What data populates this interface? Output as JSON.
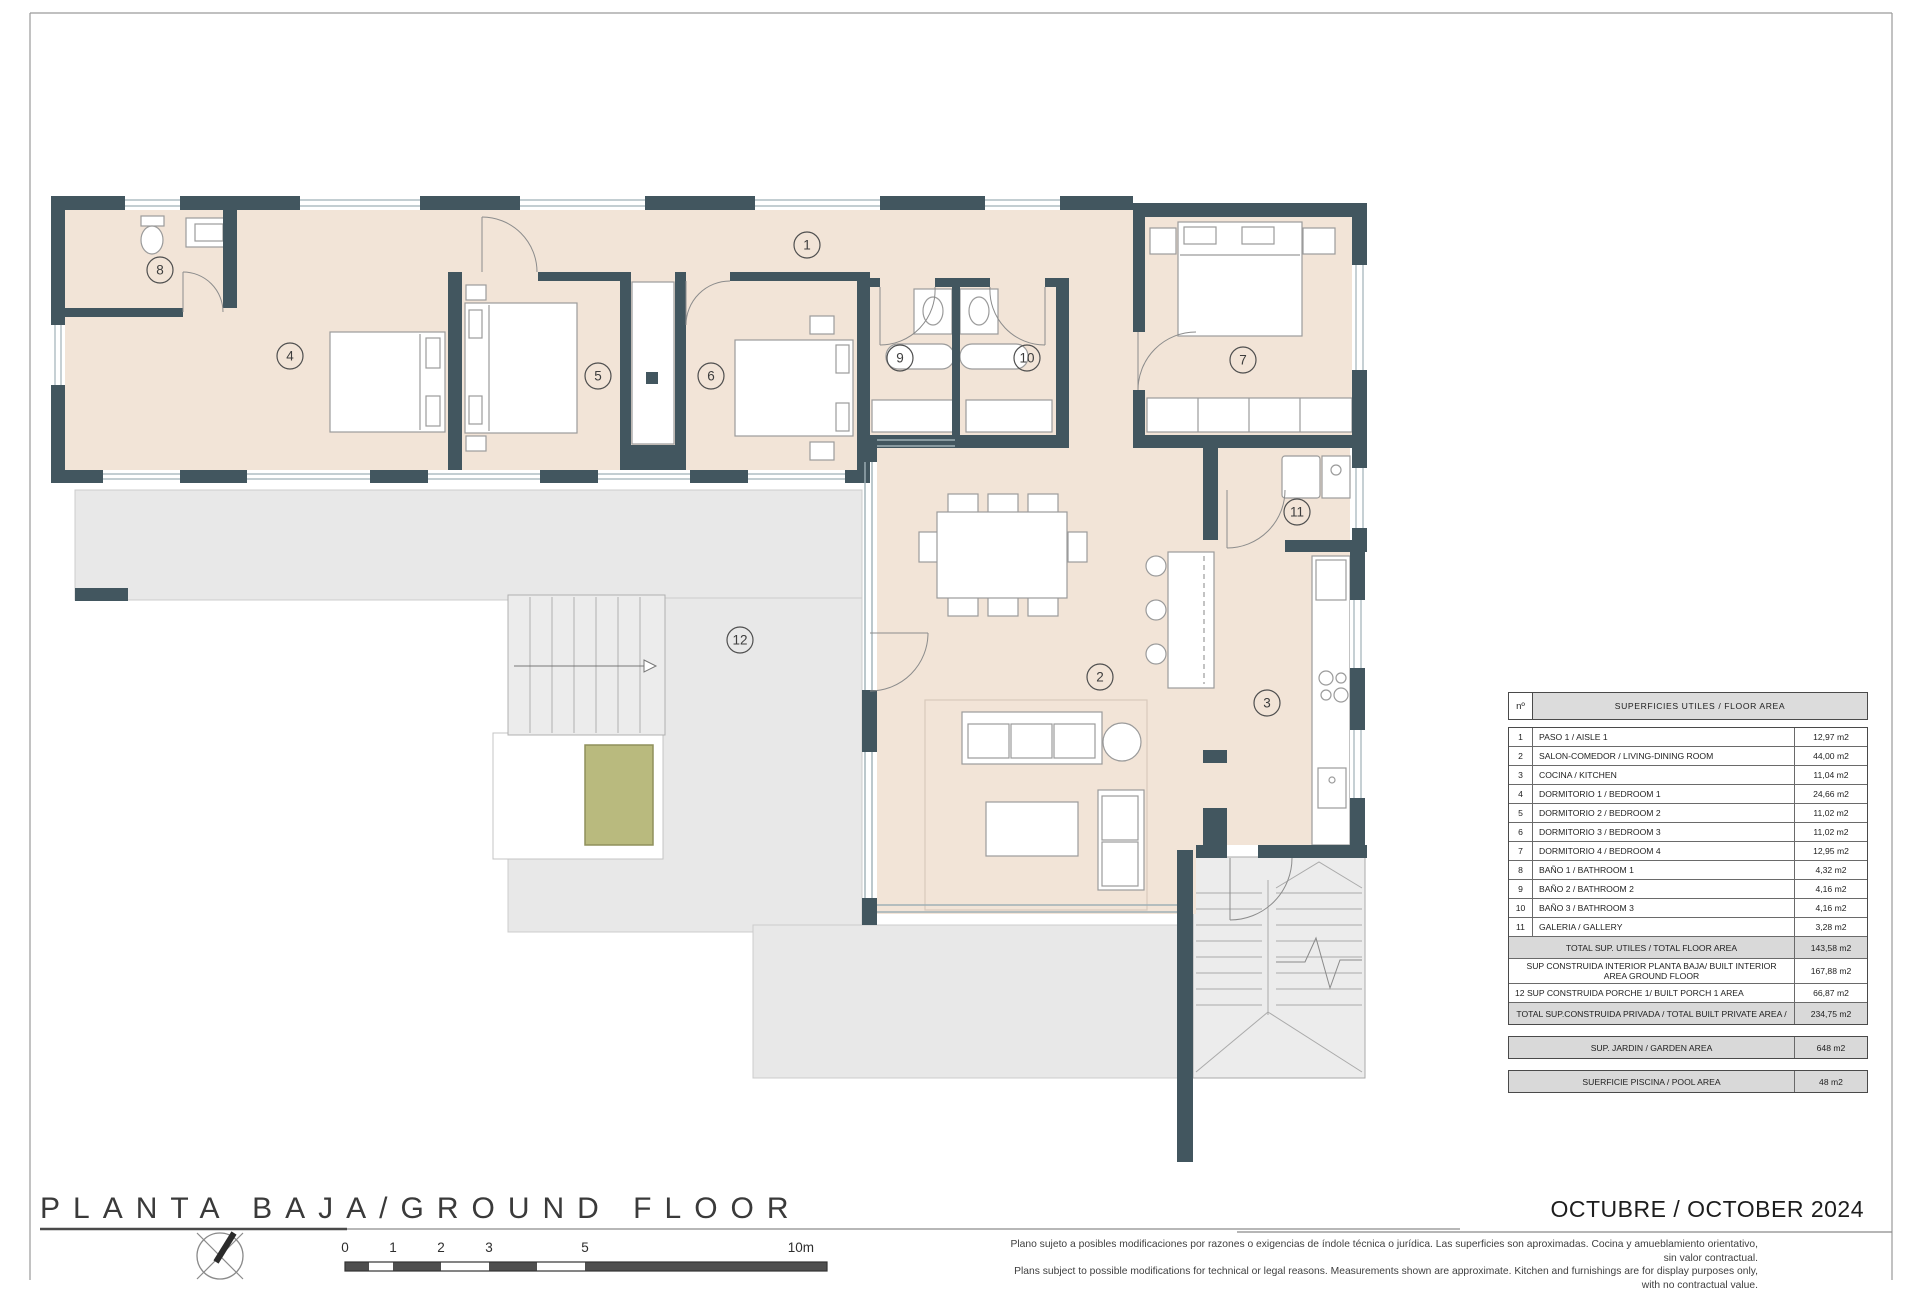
{
  "sheet": {
    "title": "PLANTA BAJA/GROUND FLOOR",
    "date": "OCTUBRE / OCTOBER 2024",
    "disclaimer_line1": "Plano sujeto a posibles modificaciones por razones o exigencias de índole técnica o jurídica. Las superficies son aproximadas. Cocina y amueblamiento orientativo, sin valor contractual.",
    "disclaimer_line2": "Plans subject to possible modifications for technical or legal reasons. Measurements shown are approximate. Kitchen and furnishings are for display purposes only, with no contractual value."
  },
  "table": {
    "header_num": "nº",
    "header_title": "SUPERFICIES UTILES  / FLOOR AREA",
    "rows": [
      {
        "num": "1",
        "label": "PASO 1 / AISLE 1",
        "value": "12,97 m2"
      },
      {
        "num": "2",
        "label": "SALON-COMEDOR /  LIVING-DINING ROOM",
        "value": "44,00 m2"
      },
      {
        "num": "3",
        "label": "COCINA / KITCHEN",
        "value": "11,04 m2"
      },
      {
        "num": "4",
        "label": "DORMITORIO 1 / BEDROOM 1",
        "value": "24,66 m2"
      },
      {
        "num": "5",
        "label": "DORMITORIO 2 / BEDROOM 2",
        "value": "11,02 m2"
      },
      {
        "num": "6",
        "label": "DORMITORIO 3 / BEDROOM 3",
        "value": "11,02 m2"
      },
      {
        "num": "7",
        "label": "DORMITORIO 4 / BEDROOM 4",
        "value": "12,95 m2"
      },
      {
        "num": "8",
        "label": "BAÑO 1 / BATHROOM 1",
        "value": "4,32 m2"
      },
      {
        "num": "9",
        "label": "BAÑO 2 / BATHROOM 2",
        "value": "4,16 m2"
      },
      {
        "num": "10",
        "label": "BAÑO 3 / BATHROOM 3",
        "value": "4,16 m2"
      },
      {
        "num": "11",
        "label": "GALERIA / GALLERY",
        "value": "3,28 m2"
      }
    ],
    "summary": [
      {
        "label": "TOTAL SUP. UTILES / TOTAL FLOOR AREA",
        "value": "143,58 m2",
        "style": "shaded"
      },
      {
        "label": "SUP CONSTRUIDA INTERIOR PLANTA BAJA/ BUILT INTERIOR AREA GROUND FLOOR",
        "value": "167,88 m2",
        "style": "plain"
      },
      {
        "num": "12",
        "label": "SUP CONSTRUIDA PORCHE 1/ BUILT PORCH 1 AREA",
        "value": "66,87 m2",
        "style": "plain"
      },
      {
        "label": "TOTAL SUP.CONSTRUIDA PRIVADA / TOTAL  BUILT PRIVATE AREA /",
        "value": "234,75 m2",
        "style": "shaded"
      }
    ],
    "extra_boxes": [
      {
        "label": "SUP. JARDIN / GARDEN AREA",
        "value": "648 m2"
      },
      {
        "label": "SUERFICIE PISCINA / POOL AREA",
        "value": "48 m2"
      }
    ]
  },
  "rooms": [
    {
      "num": "1",
      "name": "PASO 1 / AISLE 1",
      "marker": {
        "x": 807,
        "y": 245
      }
    },
    {
      "num": "2",
      "name": "SALON-COMEDOR",
      "marker": {
        "x": 1100,
        "y": 677
      }
    },
    {
      "num": "3",
      "name": "COCINA / KITCHEN",
      "marker": {
        "x": 1267,
        "y": 703
      }
    },
    {
      "num": "4",
      "name": "DORMITORIO 1 / BEDROOM 1",
      "marker": {
        "x": 290,
        "y": 356
      }
    },
    {
      "num": "5",
      "name": "DORMITORIO 2 / BEDROOM 2",
      "marker": {
        "x": 598,
        "y": 376
      }
    },
    {
      "num": "6",
      "name": "DORMITORIO 3 / BEDROOM 3",
      "marker": {
        "x": 711,
        "y": 376
      }
    },
    {
      "num": "7",
      "name": "DORMITORIO 4 / BEDROOM 4",
      "marker": {
        "x": 1243,
        "y": 360
      }
    },
    {
      "num": "8",
      "name": "BAÑO 1 / BATHROOM 1",
      "marker": {
        "x": 160,
        "y": 270
      }
    },
    {
      "num": "9",
      "name": "BAÑO 2 / BATHROOM 2",
      "marker": {
        "x": 900,
        "y": 358
      }
    },
    {
      "num": "10",
      "name": "BAÑO 3 / BATHROOM 3",
      "marker": {
        "x": 1027,
        "y": 358
      }
    },
    {
      "num": "11",
      "name": "GALERIA / GALLERY",
      "marker": {
        "x": 1297,
        "y": 512
      }
    },
    {
      "num": "12",
      "name": "PORCHE 1 / PORCH 1",
      "marker": {
        "x": 740,
        "y": 640
      }
    }
  ],
  "scale_bar": {
    "labels": [
      {
        "t": "0",
        "x": 345
      },
      {
        "t": "1",
        "x": 393
      },
      {
        "t": "2",
        "x": 441
      },
      {
        "t": "3",
        "x": 489
      },
      {
        "t": "5",
        "x": 585
      },
      {
        "t": "10m",
        "x": 814
      }
    ]
  },
  "colors": {
    "wall": "#42565f",
    "floor": "#f2e4d7",
    "terrace": "#e8e8e8",
    "pool": "#b9ba7e",
    "accent_line": "#9fb0b6"
  }
}
